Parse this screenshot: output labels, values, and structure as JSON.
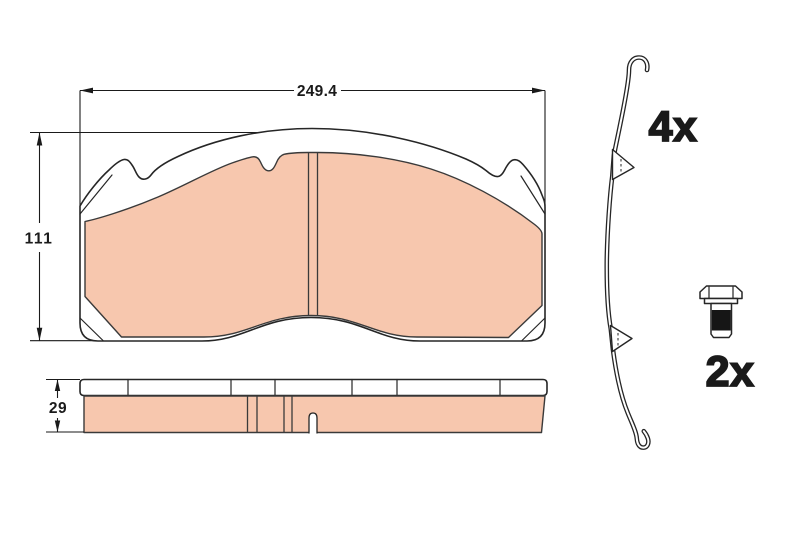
{
  "diagram": {
    "background": "#ffffff",
    "outline_color": "#262626",
    "friction_color": "#f7c7ae",
    "thread_color": "#161616",
    "text_color": "#1a1a1a",
    "front_view": {
      "width_label": "249.4",
      "height_label": "111"
    },
    "side_view": {
      "thickness_label": "29"
    },
    "accessories": {
      "spring_quantity": "4x",
      "bolt_quantity": "2x"
    }
  }
}
